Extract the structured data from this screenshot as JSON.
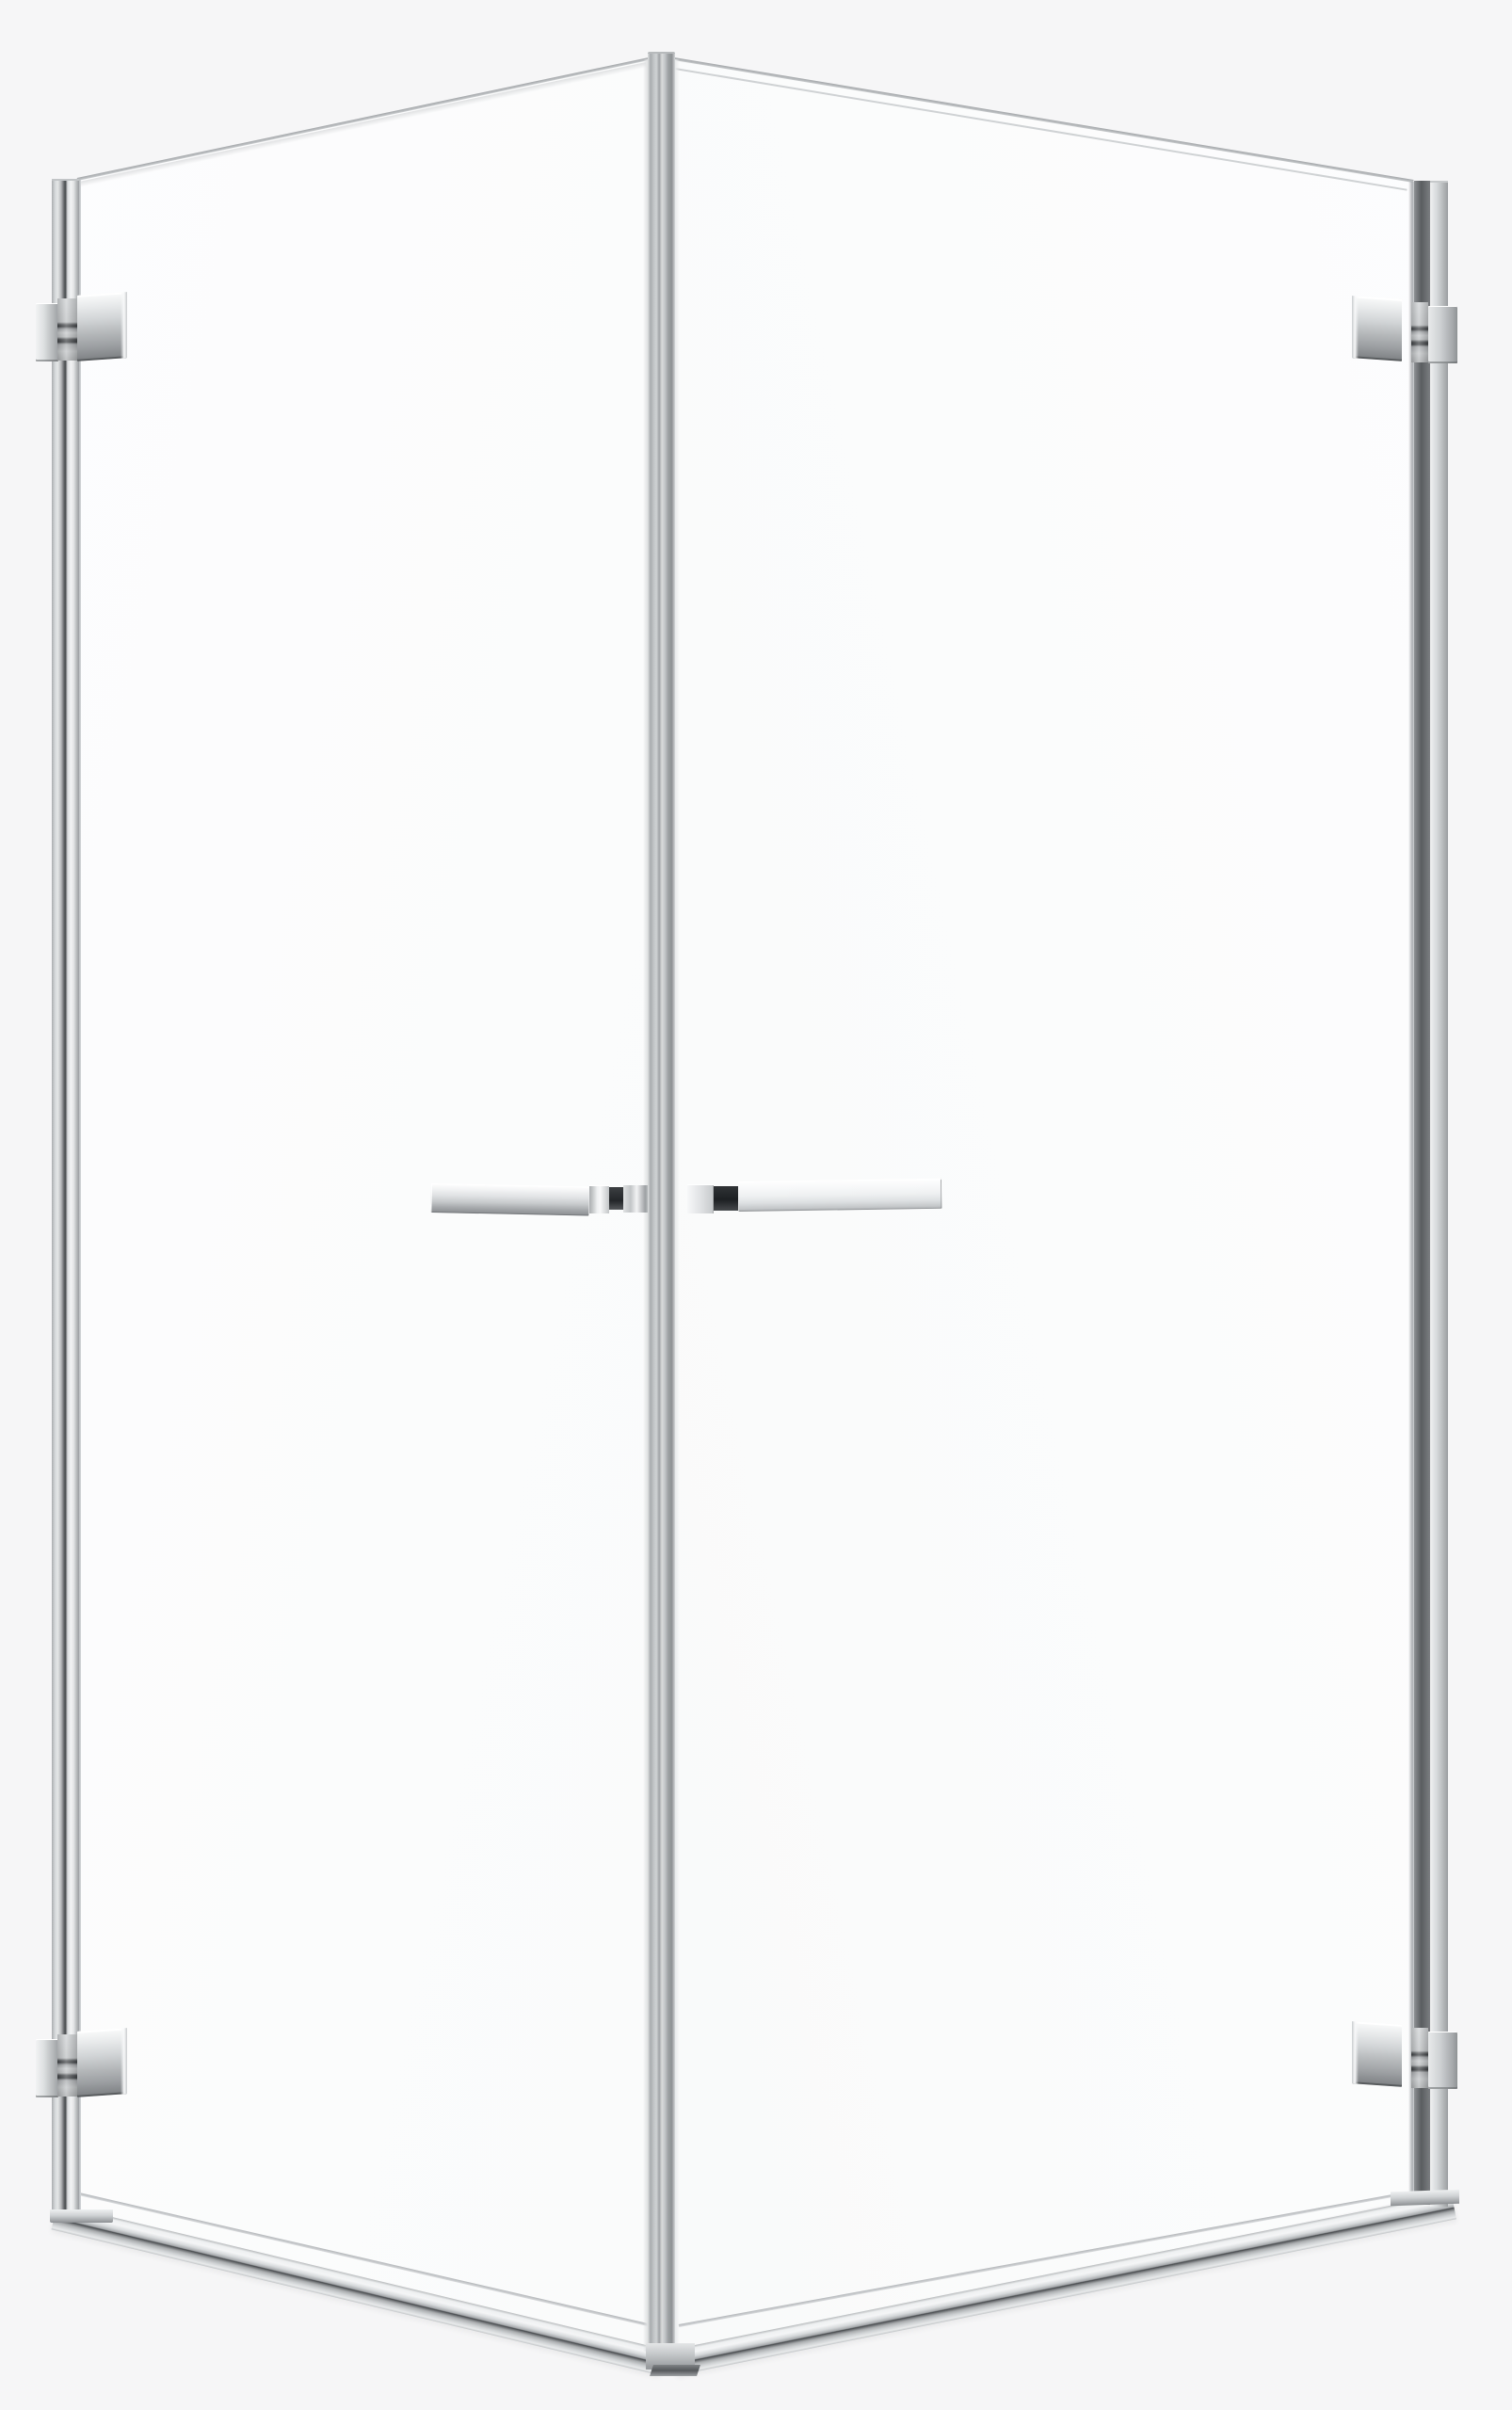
{
  "image": {
    "type": "product-photo",
    "subject": "Corner shower enclosure with two hinged clear-glass doors and chrome hardware on a plain light background",
    "palette": {
      "background": "#f6f6f7",
      "glass": "#fcfdfd",
      "chrome_light": "#f2f3f4",
      "chrome_mid": "#c2c5c7",
      "chrome_dark": "#8e9194",
      "seam_dark": "#3c3f42",
      "handle_pad_dark": "#26292c"
    }
  },
  "parts": {
    "canvas": "shower enclosure product photo",
    "left_door": "left glass door panel",
    "right_door": "right glass door panel",
    "left_wall_profile": "left wall mounting profile",
    "right_wall_profile": "right wall mounting profile",
    "left_wall_profile_foot": "left wall profile floor foot",
    "right_wall_profile_foot": "right wall profile floor foot",
    "corner_post": "front corner post profile",
    "corner_post_foot": "corner post floor foot",
    "hinge_top_left": "top hinge of left door",
    "hinge_bottom_left": "bottom hinge of left door",
    "hinge_top_right": "top hinge of right door",
    "hinge_bottom_right": "bottom hinge of right door",
    "left_handle": "left door horizontal handle",
    "right_handle": "right door horizontal handle",
    "left_threshold": "left bottom threshold rail",
    "right_threshold": "right bottom threshold rail"
  }
}
